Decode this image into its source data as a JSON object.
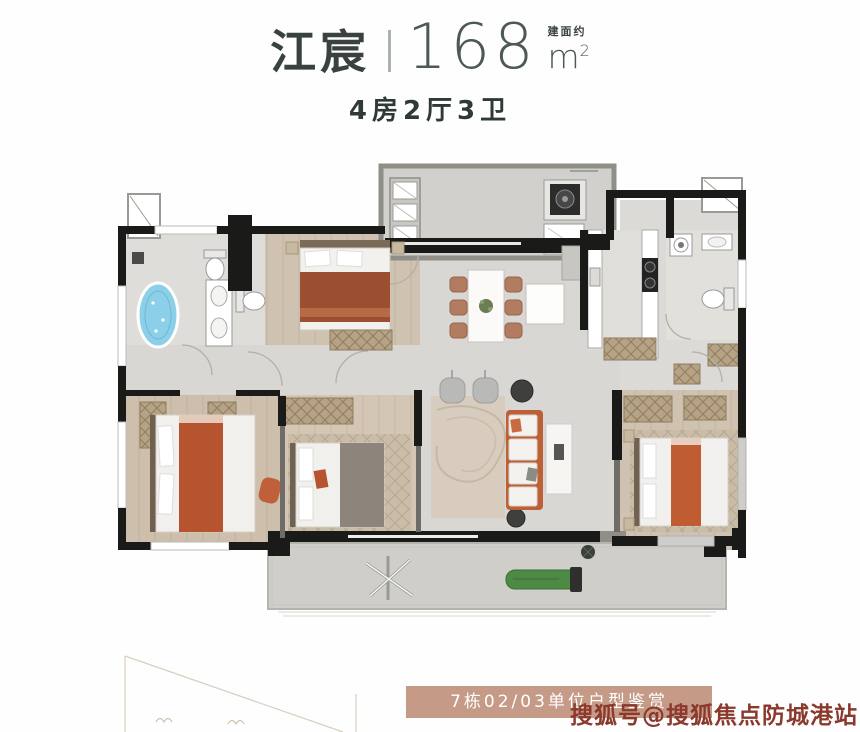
{
  "header": {
    "title": "江宸",
    "area_prefix": "建面约",
    "area_value": "168",
    "area_unit": "m",
    "area_sup": "2",
    "layout": "4房2厅3卫"
  },
  "footer": {
    "banner": "7栋02/03单位户型鉴赏",
    "watermark": "搜狐号@搜狐焦点防城港站"
  },
  "colors": {
    "title_text": "#39423f",
    "thin_numeral": "#4e5957",
    "banner_bg": "#c59b88",
    "banner_text": "#ffffff",
    "watermark_text": "#8a392c",
    "wall_black": "#1a1a18",
    "tile_floor": "#d9d7d3",
    "wood_floor": "#cfc2b0",
    "accent_orange": "#b5542e",
    "bathtub_blue": "#8ccfe8",
    "lounger_green": "#4c8a45"
  }
}
